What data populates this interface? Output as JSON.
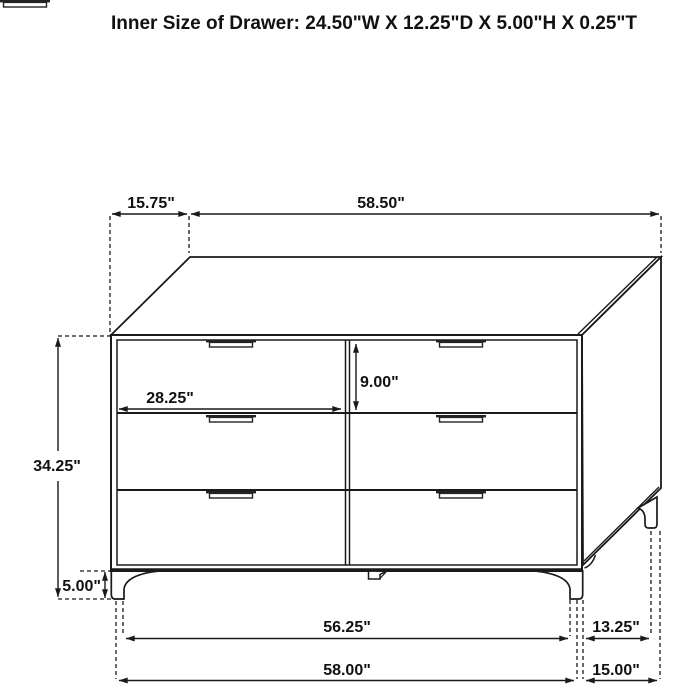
{
  "title": "Inner Size of Drawer: 24.50\"W X 12.25\"D X 5.00\"H X 0.25\"T",
  "figure": {
    "kind": "furniture-dimension-diagram",
    "object": "six-drawer dresser",
    "line_color": "#1a1a1a",
    "background_color": "#ffffff"
  },
  "dims": {
    "top_depth": "15.75\"",
    "top_width": "58.50\"",
    "overall_height": "34.25\"",
    "drawer_width": "28.25\"",
    "drawer_height": "9.00\"",
    "leg_height": "5.00\"",
    "front_leg_span": "56.25\"",
    "side_leg_span": "13.25\"",
    "front_overall_width": "58.00\"",
    "side_overall_depth": "15.00\""
  }
}
